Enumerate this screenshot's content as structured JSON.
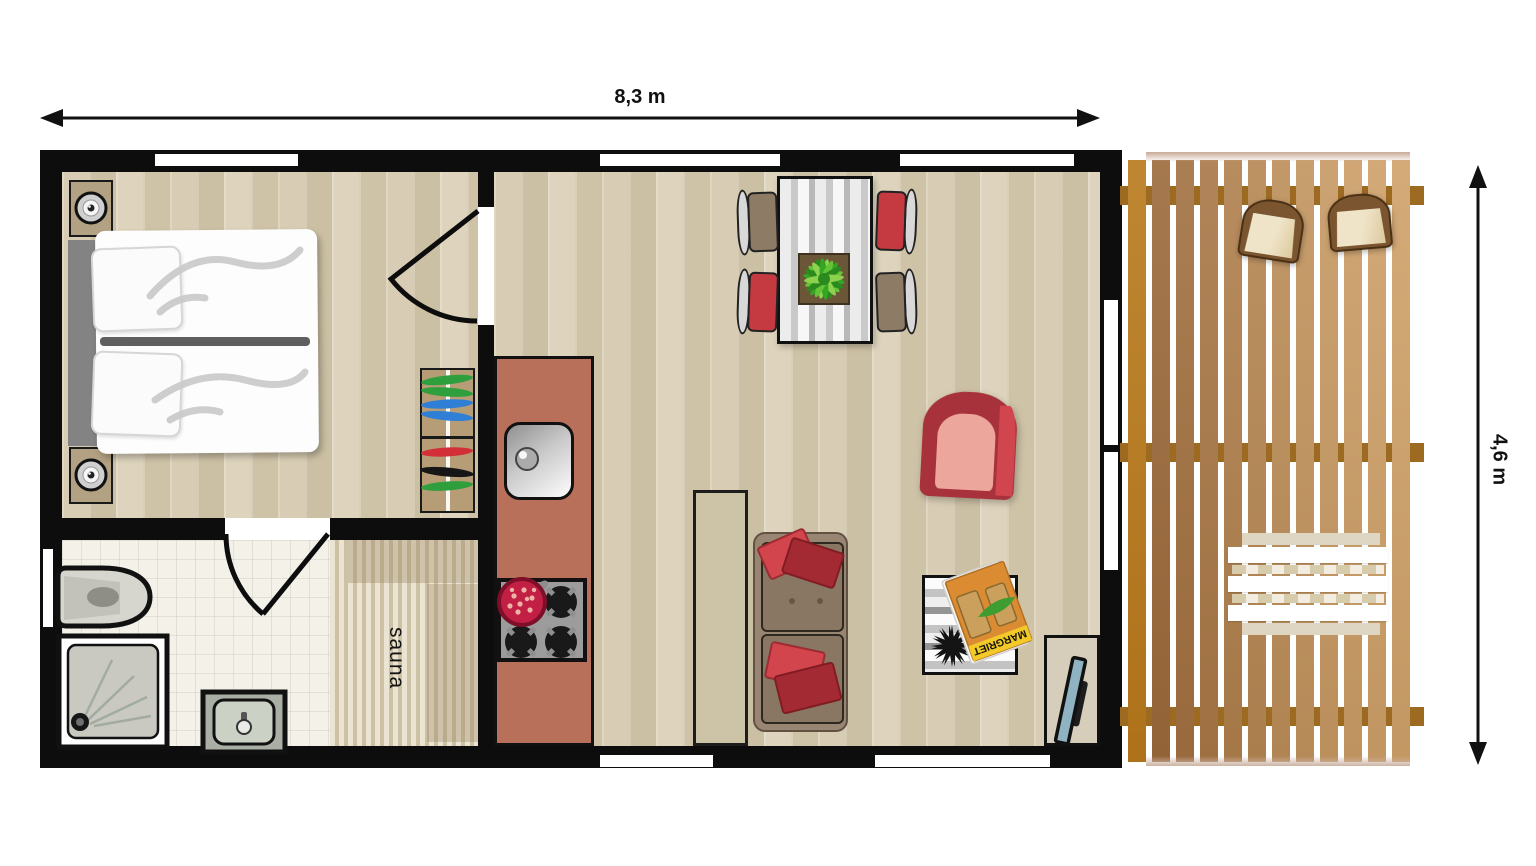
{
  "dimensions": {
    "width_label": "8,3 m",
    "depth_label": "4,6 m"
  },
  "labels": {
    "sauna": "sauna"
  },
  "magazine": {
    "title": "MARGRIET"
  },
  "colors": {
    "wall": "#0d0d0d",
    "parquet_floor": "#d3c7ad",
    "bathroom_tile": "#f3f1e8",
    "sauna_wood": "#ece4d3",
    "kitchen_counter": "#b9705a",
    "deck_plank": "#b8791b",
    "deck_beam": "#9c6a20",
    "pot_red": "#c21f45",
    "armchair_red": "#a8323c",
    "throw_pillow_red": "#d2454d",
    "dining_chair_red": "#c53a40",
    "dining_chair_brown": "#8d7b66",
    "sofa_brown": "#998672",
    "magazine_banner_yellow": "#f2c928",
    "tv_screen_blue": "#8fb3c0"
  }
}
